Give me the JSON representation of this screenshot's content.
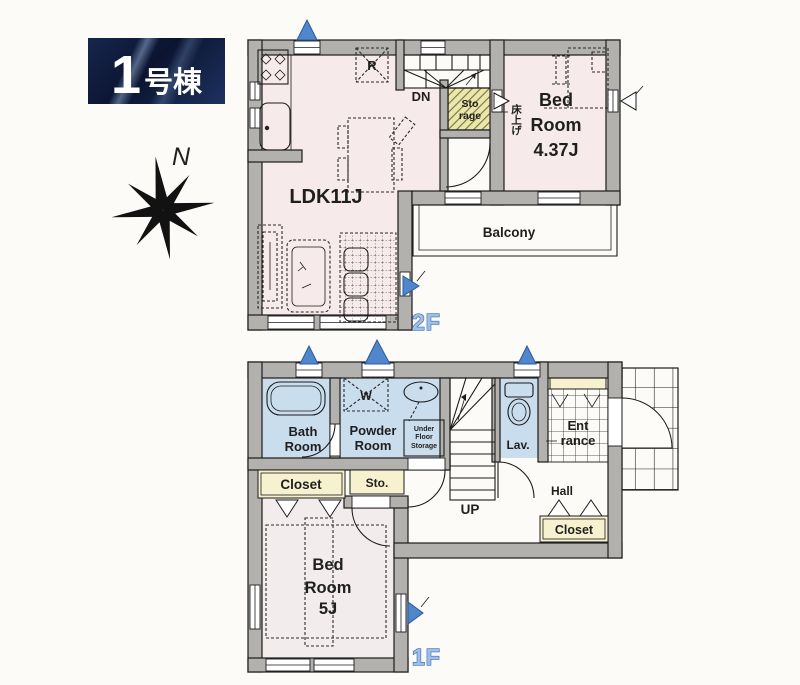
{
  "badge": {
    "number": "1",
    "suffix": "号棟"
  },
  "compass": {
    "label": "N"
  },
  "colors": {
    "wall": "#b3b1ae",
    "pink": "#f7eaea",
    "wet": "#cadded",
    "cream": "#f6f1cf",
    "accent": "#4f86cc",
    "accent-dark": "#2b5a9e",
    "fl-fill": "#9fc0e6",
    "fl-stroke": "#3a6cb8",
    "navy1": "#0b1430",
    "navy2": "#1d3260"
  },
  "floor2": {
    "label": "2F",
    "ldk": "LDK11J",
    "bedroom": {
      "l1": "Bed",
      "l2": "Room",
      "l3": "4.37J"
    },
    "balcony": "Balcony",
    "storage": {
      "l1": "Sto",
      "l2": "rage"
    },
    "stairs_down": "DN",
    "raised_floor": "床上げ",
    "fridge": "R"
  },
  "floor1": {
    "label": "1F",
    "bath": {
      "l1": "Bath",
      "l2": "Room"
    },
    "powder": {
      "l1": "Powder",
      "l2": "Room"
    },
    "under_floor": {
      "l1": "Under",
      "l2": "Floor",
      "l3": "Storage"
    },
    "washer": "W",
    "lav": "Lav.",
    "entrance": {
      "l1": "Ent",
      "l2": "rance"
    },
    "sto": "Sto.",
    "closet": "Closet",
    "hall_closet": "Closet",
    "hall": "Hall",
    "stairs_up": "UP",
    "bedroom": {
      "l1": "Bed",
      "l2": "Room",
      "l3": "5J"
    }
  }
}
